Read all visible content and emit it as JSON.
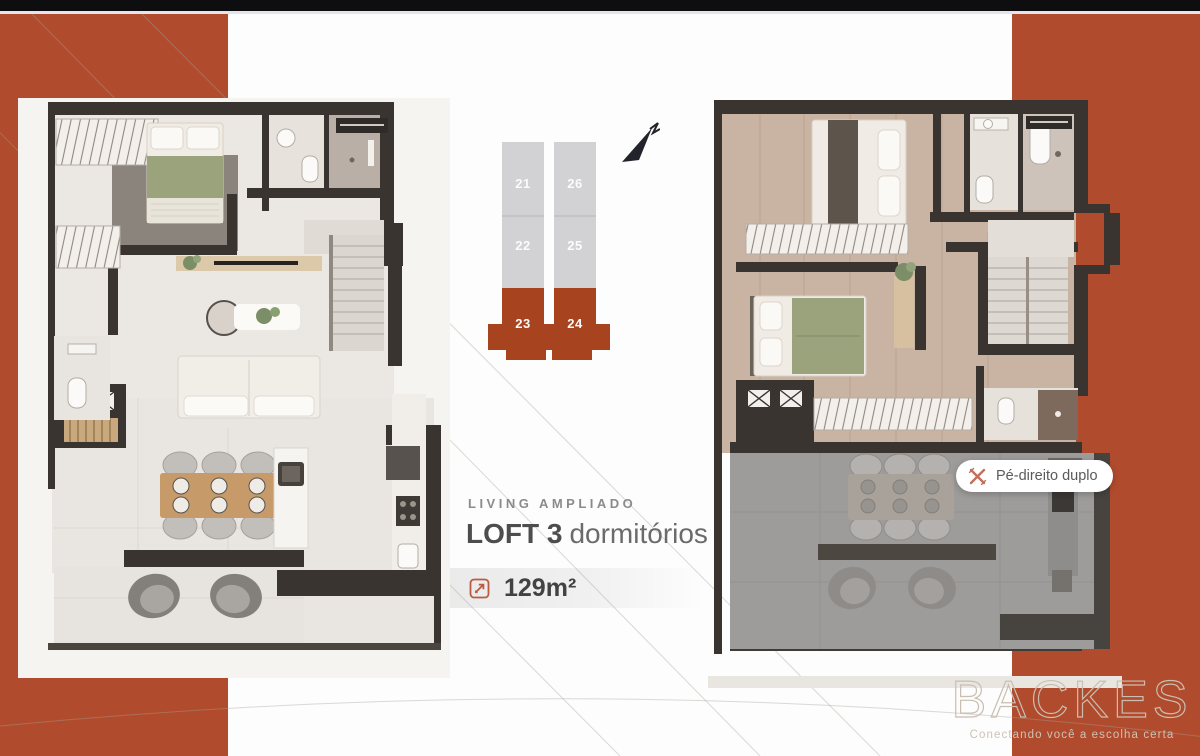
{
  "colors": {
    "accent_red": "#b14b2d",
    "key_highlight": "#a8431f",
    "key_gray": "#d2d2d4",
    "wall": "#3a3430"
  },
  "key_plan": {
    "tower_left": [
      "21",
      "22",
      "23"
    ],
    "tower_right": [
      "26",
      "25",
      "24"
    ],
    "highlighted_units": [
      "23",
      "24"
    ]
  },
  "info": {
    "eyebrow": "LIVING AMPLIADO",
    "title_strong": "LOFT 3",
    "title_rest": "dormitórios",
    "area": "129m²"
  },
  "badge": {
    "label": "Pé-direito duplo"
  },
  "brand": {
    "name": "BACKES",
    "tagline": "Conectando você a escolha certa"
  }
}
